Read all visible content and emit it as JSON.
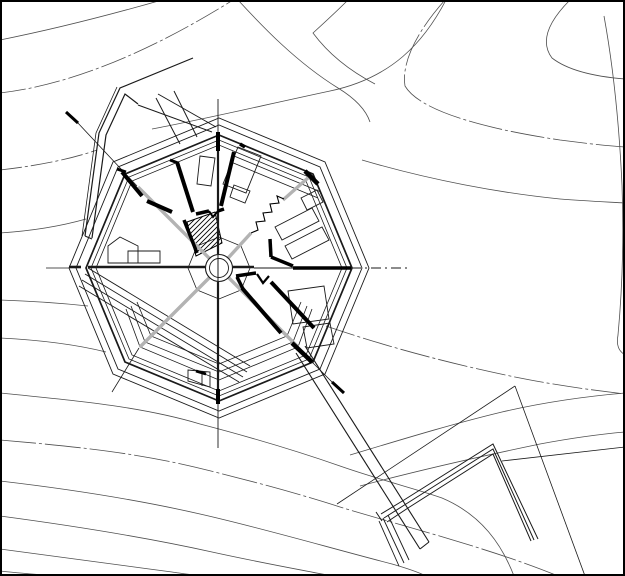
{
  "document": {
    "alt_text": "Architectural site plan: octagonal building with radial interior walls, center circular stair core, topographic contour lines, angled retaining wall to the northwest, and a long walkway leading to an angled terrace wall at the lower right. No text is visible in the drawing.",
    "canvas": {
      "width": 625,
      "height": 576,
      "background": "#ffffff"
    }
  },
  "colors": {
    "line": "#1a1a1a",
    "contour": "#4f4f4f",
    "gray": "#b3b3b3",
    "black": "#000000",
    "white": "#ffffff",
    "border": "#000000"
  },
  "drawing": {
    "border": {
      "x": 1,
      "y": 1,
      "w": 623,
      "h": 574,
      "stroke_w": 2
    },
    "layers": [
      {
        "name": "contour-lines",
        "strokes": [
          {
            "d": "M0,40 C60,28 120,12 162,0",
            "w": 0.8,
            "c": "contour"
          },
          {
            "d": "M0,93 C70,85 150,52 233,0",
            "w": 0.8,
            "c": "contour",
            "dash": "26 3 3 3"
          },
          {
            "d": "M0,170 C35,166 68,160 97,150",
            "w": 0.8,
            "c": "contour",
            "dash": "22 3 3 3"
          },
          {
            "d": "M0,233 C30,231 58,227 86,219",
            "w": 0.8,
            "c": "contour"
          },
          {
            "d": "M152,129 C200,120 260,106 330,91 C392,78 424,42 446,0",
            "w": 0.8,
            "c": "contour"
          },
          {
            "d": "M238,0 C262,26 296,62 338,88 C356,99 366,110 370,122",
            "w": 0.8,
            "c": "contour"
          },
          {
            "d": "M348,0 C337,11 324,23 313,33 C330,56 352,72 375,84",
            "w": 0.8,
            "c": "contour"
          },
          {
            "d": "M445,0 C420,28 401,60 405,86 C419,110 480,128 560,140 C590,144 610,146 625,147",
            "w": 0.8,
            "c": "contour",
            "dash": "34 3 3 3"
          },
          {
            "d": "M570,0 C548,22 540,42 552,58 C570,72 600,77 625,79",
            "w": 0.8,
            "c": "contour"
          },
          {
            "d": "M604,16 C612,60 619,120 622,185 C624,240 622,292 618,335 C616,346 619,351 625,355",
            "w": 0.8,
            "c": "contour"
          },
          {
            "d": "M362,160 C430,180 500,193 560,199 C585,201 608,202 625,203",
            "w": 0.8,
            "c": "contour"
          },
          {
            "d": "M326,326 C390,348 460,366 520,378 C560,386 600,391 625,394",
            "w": 0.8,
            "c": "contour",
            "dash": "30 3 3 3"
          },
          {
            "d": "M350,455 C400,440 452,424 502,412 C545,402 590,396 625,393",
            "w": 0.8,
            "c": "contour"
          },
          {
            "d": "M360,486 C420,470 482,456 540,444 C572,438 602,434 625,432",
            "w": 0.8,
            "c": "contour"
          },
          {
            "d": "M0,300 C30,301 60,303 88,306",
            "w": 0.8,
            "c": "contour"
          },
          {
            "d": "M0,338 C40,340 78,345 106,352",
            "w": 0.8,
            "c": "contour"
          },
          {
            "d": "M0,393 C70,400 140,406 200,424 C250,437 300,452 340,466 C380,480 420,490 442,498 C482,515 502,545 514,576",
            "w": 0.8,
            "c": "contour"
          },
          {
            "d": "M0,440 C70,446 130,452 190,466 C245,479 300,494 340,507 C395,524 490,548 558,576",
            "w": 0.8,
            "c": "contour",
            "dash": "36 3 3 3"
          },
          {
            "d": "M0,481 C60,488 130,498 200,514 C262,528 330,548 392,564 C406,568 418,572 426,576",
            "w": 0.8,
            "c": "contour"
          },
          {
            "d": "M0,516 C60,524 140,536 212,552 C262,563 302,570 332,576",
            "w": 0.8,
            "c": "contour"
          },
          {
            "d": "M0,549 C50,556 112,564 172,572 C186,574 198,576 206,576",
            "w": 0.8,
            "c": "contour"
          },
          {
            "d": "M0,571 C26,574 46,575 60,576",
            "w": 0.8,
            "c": "contour"
          }
        ]
      },
      {
        "name": "site-structures",
        "strokes": [
          {
            "d": "M82,236 L96,133 L117,87",
            "w": 0.8,
            "c": "line"
          },
          {
            "d": "M85,236 L99,133 L120,88 L193,58",
            "w": 1.2,
            "c": "line"
          },
          {
            "d": "M92,238 L106,135 L125,94 L138,104",
            "w": 1.2,
            "c": "line"
          },
          {
            "d": "M85,236 L92,239",
            "w": 1.2,
            "c": "line"
          },
          {
            "d": "M138,105 L212,132",
            "w": 1,
            "c": "line"
          },
          {
            "d": "M158,94 L216,127",
            "w": 1,
            "c": "line"
          },
          {
            "d": "M156,98 L180,144",
            "w": 1,
            "c": "line"
          },
          {
            "d": "M174,91 L197,137",
            "w": 1,
            "c": "line"
          },
          {
            "d": "M88,268 L250,366",
            "w": 0.9,
            "c": "line"
          },
          {
            "d": "M85,274 L247,372",
            "w": 0.9,
            "c": "line"
          },
          {
            "d": "M82,280 L243,377",
            "w": 0.9,
            "c": "line"
          },
          {
            "d": "M79,286 L239,382",
            "w": 0.9,
            "c": "line"
          },
          {
            "d": "M296,353 L420,549",
            "w": 1.1,
            "c": "line"
          },
          {
            "d": "M305,346 L429,542",
            "w": 1.1,
            "c": "line"
          },
          {
            "d": "M420,549 L429,542",
            "w": 1.1,
            "c": "line"
          },
          {
            "d": "M379,521 L399,566",
            "w": 0.9,
            "c": "line"
          },
          {
            "d": "M383,518 L404,563",
            "w": 0.9,
            "c": "line"
          },
          {
            "d": "M388,515 L409,560",
            "w": 0.9,
            "c": "line"
          },
          {
            "d": "M381,514 L404,500 L493,444 L538,539",
            "w": 1,
            "c": "line"
          },
          {
            "d": "M384,518 L406,504 L493,449 L534,540",
            "w": 1,
            "c": "line"
          },
          {
            "d": "M387,522 L408,508 L493,454 L531,541",
            "w": 1,
            "c": "line"
          },
          {
            "d": "M376,512 L382,521",
            "w": 1,
            "c": "line"
          },
          {
            "d": "M515,386 L337,504",
            "w": 0.8,
            "c": "line"
          },
          {
            "d": "M515,386 L585,576",
            "w": 0.8,
            "c": "line"
          },
          {
            "d": "M502,461 L625,447",
            "w": 0.8,
            "c": "line"
          },
          {
            "d": "M77,122 L137,186",
            "w": 0.8,
            "c": "line"
          },
          {
            "d": "M312,362 L338,388",
            "w": 0.8,
            "c": "line"
          },
          {
            "d": "M139,348 L112,392",
            "w": 0.8,
            "c": "line"
          }
        ]
      },
      {
        "name": "building-rings",
        "strokes": [
          {
            "d": "M369,268 L325,162 L219,118 L113,162 L69,268 L113,374 L219,418 L325,374 Z",
            "w": 0.9,
            "c": "line"
          },
          {
            "d": "M362,268 L320,167 L219,125 L118,167 L76,268 L118,369 L219,411 L320,369 Z",
            "w": 0.9,
            "c": "line"
          },
          {
            "d": "M352,268 L313,174 L219,135 L125,174 L86,268 L125,362 L219,401 L313,362 Z",
            "w": 1.7,
            "c": "line"
          },
          {
            "d": "M347,268 L309,177 L219,140 L129,177 L91,268 L129,359 L219,396 L309,359 Z",
            "w": 0.8,
            "c": "line"
          },
          {
            "d": "M342,268 L306,181 L219,145 L132,181 L96,268 L132,355 L219,391 L306,355 Z",
            "w": 0.8,
            "c": "line"
          },
          {
            "d": "M137,302 L151,336 L219,364 L287,336 L301,302",
            "w": 0.8,
            "c": "line"
          },
          {
            "d": "M131,306 L145,342 L219,372 L293,342 L307,306",
            "w": 0.8,
            "c": "line"
          },
          {
            "d": "M126,309 L140,347 L219,380 L298,347 L312,309",
            "w": 0.8,
            "c": "line"
          },
          {
            "d": "M250,268 L241,246 L219,237 L197,246 L188,268 L197,290 L219,299 L241,290 Z",
            "w": 0.8,
            "c": "line"
          },
          {
            "d": "M231,162 L318,198",
            "w": 0.8,
            "c": "line"
          },
          {
            "d": "M234,156 L321,192",
            "w": 0.8,
            "c": "line"
          }
        ]
      },
      {
        "name": "room-outlines",
        "strokes": [
          {
            "d": "M238,147 L261,156 L246,193 L223,184 Z",
            "w": 0.9,
            "c": "line"
          },
          {
            "d": "M200,156 L215,158 L211,186 L197,184 Z",
            "w": 0.9,
            "c": "line"
          },
          {
            "d": "M234,185 L250,191 L245,203 L230,197 Z",
            "w": 0.9,
            "c": "line"
          },
          {
            "d": "M275,227 L312,208 L319,221 L282,240 Z",
            "w": 0.9,
            "c": "line"
          },
          {
            "d": "M285,246 L322,227 L329,240 L292,259 Z",
            "w": 0.9,
            "c": "line"
          },
          {
            "d": "M301,198 L317,190 L323,202 L307,210 Z",
            "w": 0.9,
            "c": "line"
          },
          {
            "d": "M288,291 L324,286 L329,319 L293,324 Z",
            "w": 0.9,
            "c": "line"
          },
          {
            "d": "M303,327 L330,323 L334,344 L307,348 Z",
            "w": 0.9,
            "c": "line"
          },
          {
            "d": "M108,263 L108,246 L120,237 L138,246 L138,263 Z",
            "w": 0.9,
            "c": "line"
          },
          {
            "d": "M128,251 L160,251 L160,263 L128,263 Z",
            "w": 0.9,
            "c": "line"
          },
          {
            "d": "M188,370 L210,372 L210,387 L188,381 Z",
            "w": 0.9,
            "c": "line"
          },
          {
            "d": "M202,371 L202,386",
            "w": 0.9,
            "c": "line"
          }
        ]
      },
      {
        "name": "stair-hatch",
        "clip": "M187,222 L215,212 L222,243 L196,256 Z",
        "outline": {
          "d": "M187,222 L215,212 L222,243 L196,256 Z",
          "w": 1,
          "c": "black"
        },
        "strokes": [
          {
            "d": "M151,258 L203,206",
            "w": 0.9,
            "c": "black"
          },
          {
            "d": "M156,258 L208,206",
            "w": 0.9,
            "c": "black"
          },
          {
            "d": "M161,258 L213,206",
            "w": 0.9,
            "c": "black"
          },
          {
            "d": "M166,258 L218,206",
            "w": 0.9,
            "c": "black"
          },
          {
            "d": "M171,258 L223,206",
            "w": 0.9,
            "c": "black"
          },
          {
            "d": "M176,258 L228,206",
            "w": 0.9,
            "c": "black"
          },
          {
            "d": "M181,258 L233,206",
            "w": 0.9,
            "c": "black"
          },
          {
            "d": "M186,258 L238,206",
            "w": 0.9,
            "c": "black"
          },
          {
            "d": "M191,258 L243,206",
            "w": 0.9,
            "c": "black"
          },
          {
            "d": "M196,258 L248,206",
            "w": 0.9,
            "c": "black"
          },
          {
            "d": "M201,258 L253,206",
            "w": 0.9,
            "c": "black"
          },
          {
            "d": "M206,258 L258,206",
            "w": 0.9,
            "c": "black"
          }
        ]
      },
      {
        "name": "section-radials",
        "strokes": [
          {
            "d": "M219,268 L138,187",
            "w": 3.4,
            "c": "gray"
          },
          {
            "d": "M219,268 L251,233",
            "w": 3.4,
            "c": "gray"
          },
          {
            "d": "M283,200 L309,177",
            "w": 3.4,
            "c": "gray"
          },
          {
            "d": "M219,268 L298,347",
            "w": 3.4,
            "c": "gray"
          },
          {
            "d": "M219,268 L140,347",
            "w": 3.4,
            "c": "gray"
          }
        ]
      },
      {
        "name": "center-core",
        "circles": [
          {
            "cx": 219,
            "cy": 268,
            "r": 13.5,
            "w": 1.1,
            "c": "line",
            "fill": "white"
          },
          {
            "cx": 219,
            "cy": 268,
            "r": 9.5,
            "w": 0.9,
            "c": "line",
            "fill": "none"
          }
        ]
      },
      {
        "name": "axis-lines",
        "strokes": [
          {
            "d": "M218,99 L218,136",
            "w": 0.9,
            "c": "line"
          },
          {
            "d": "M218,136 L218,254",
            "w": 2.2,
            "c": "line"
          },
          {
            "d": "M218,254 L218,282",
            "w": 1,
            "c": "line"
          },
          {
            "d": "M218,282 L218,401",
            "w": 2.2,
            "c": "line"
          },
          {
            "d": "M218,401 L218,448",
            "w": 0.9,
            "c": "line"
          },
          {
            "d": "M46,268 L69,268",
            "w": 0.8,
            "c": "line"
          },
          {
            "d": "M69,267 L81,267",
            "w": 2.6,
            "c": "line"
          },
          {
            "d": "M88,267 L205,267",
            "w": 2.6,
            "c": "line"
          },
          {
            "d": "M233,267 L254,267",
            "w": 2.6,
            "c": "line"
          },
          {
            "d": "M254,268 L293,268",
            "w": 0.9,
            "c": "line"
          },
          {
            "d": "M351,268 L410,268",
            "w": 0.9,
            "c": "line",
            "dash": "10 4 2 4"
          }
        ]
      },
      {
        "name": "thick-walls",
        "strokes": [
          {
            "d": "M218,132 L218,151",
            "w": 4,
            "c": "black"
          },
          {
            "d": "M234,152 L221,206",
            "w": 4,
            "c": "black"
          },
          {
            "d": "M177,162 L193,212",
            "w": 4,
            "c": "black"
          },
          {
            "d": "M170,160 L178,163",
            "w": 3,
            "c": "black"
          },
          {
            "d": "M122,172 L142,196",
            "w": 4,
            "c": "black"
          },
          {
            "d": "M117,169 L126,172",
            "w": 3,
            "c": "black"
          },
          {
            "d": "M147,201 L172,212",
            "w": 4,
            "c": "black"
          },
          {
            "d": "M196,214 L209,211",
            "w": 3.5,
            "c": "black"
          },
          {
            "d": "M209,211 L213,217 L218,211",
            "w": 2,
            "c": "black"
          },
          {
            "d": "M218,211 L224,209",
            "w": 3.5,
            "c": "black"
          },
          {
            "d": "M184,220 L197,253",
            "w": 3.5,
            "c": "black"
          },
          {
            "d": "M305,171 L318,184",
            "w": 4.5,
            "c": "black"
          },
          {
            "d": "M270,239 L271,257",
            "w": 3.5,
            "c": "black"
          },
          {
            "d": "M271,257 L293,266",
            "w": 3.5,
            "c": "black"
          },
          {
            "d": "M293,268 L351,268",
            "w": 3.5,
            "c": "black"
          },
          {
            "d": "M236,276 L256,273",
            "w": 3.5,
            "c": "black"
          },
          {
            "d": "M237,277 L243,289",
            "w": 3.5,
            "c": "black"
          },
          {
            "d": "M257,274 L263,283 L269,276",
            "w": 2.2,
            "c": "black"
          },
          {
            "d": "M242,288 L281,333",
            "w": 4,
            "c": "black"
          },
          {
            "d": "M271,282 L314,328",
            "w": 4,
            "c": "black"
          },
          {
            "d": "M292,343 L312,362",
            "w": 4.5,
            "c": "black"
          },
          {
            "d": "M196,371 L206,374",
            "w": 3,
            "c": "black"
          },
          {
            "d": "M218,389 L218,404",
            "w": 4,
            "c": "black"
          },
          {
            "d": "M240,144 L245,147",
            "w": 3.5,
            "c": "black"
          },
          {
            "d": "M66,112 L78,123",
            "w": 3,
            "c": "black"
          },
          {
            "d": "M332,382 L344,393",
            "w": 3,
            "c": "black"
          },
          {
            "d": "M251,233 L258,230 L256,222 L265,221 L263,213 L272,212 L270,204 L279,203 L277,196 L284,199",
            "w": 1.1,
            "c": "black"
          }
        ]
      }
    ]
  }
}
